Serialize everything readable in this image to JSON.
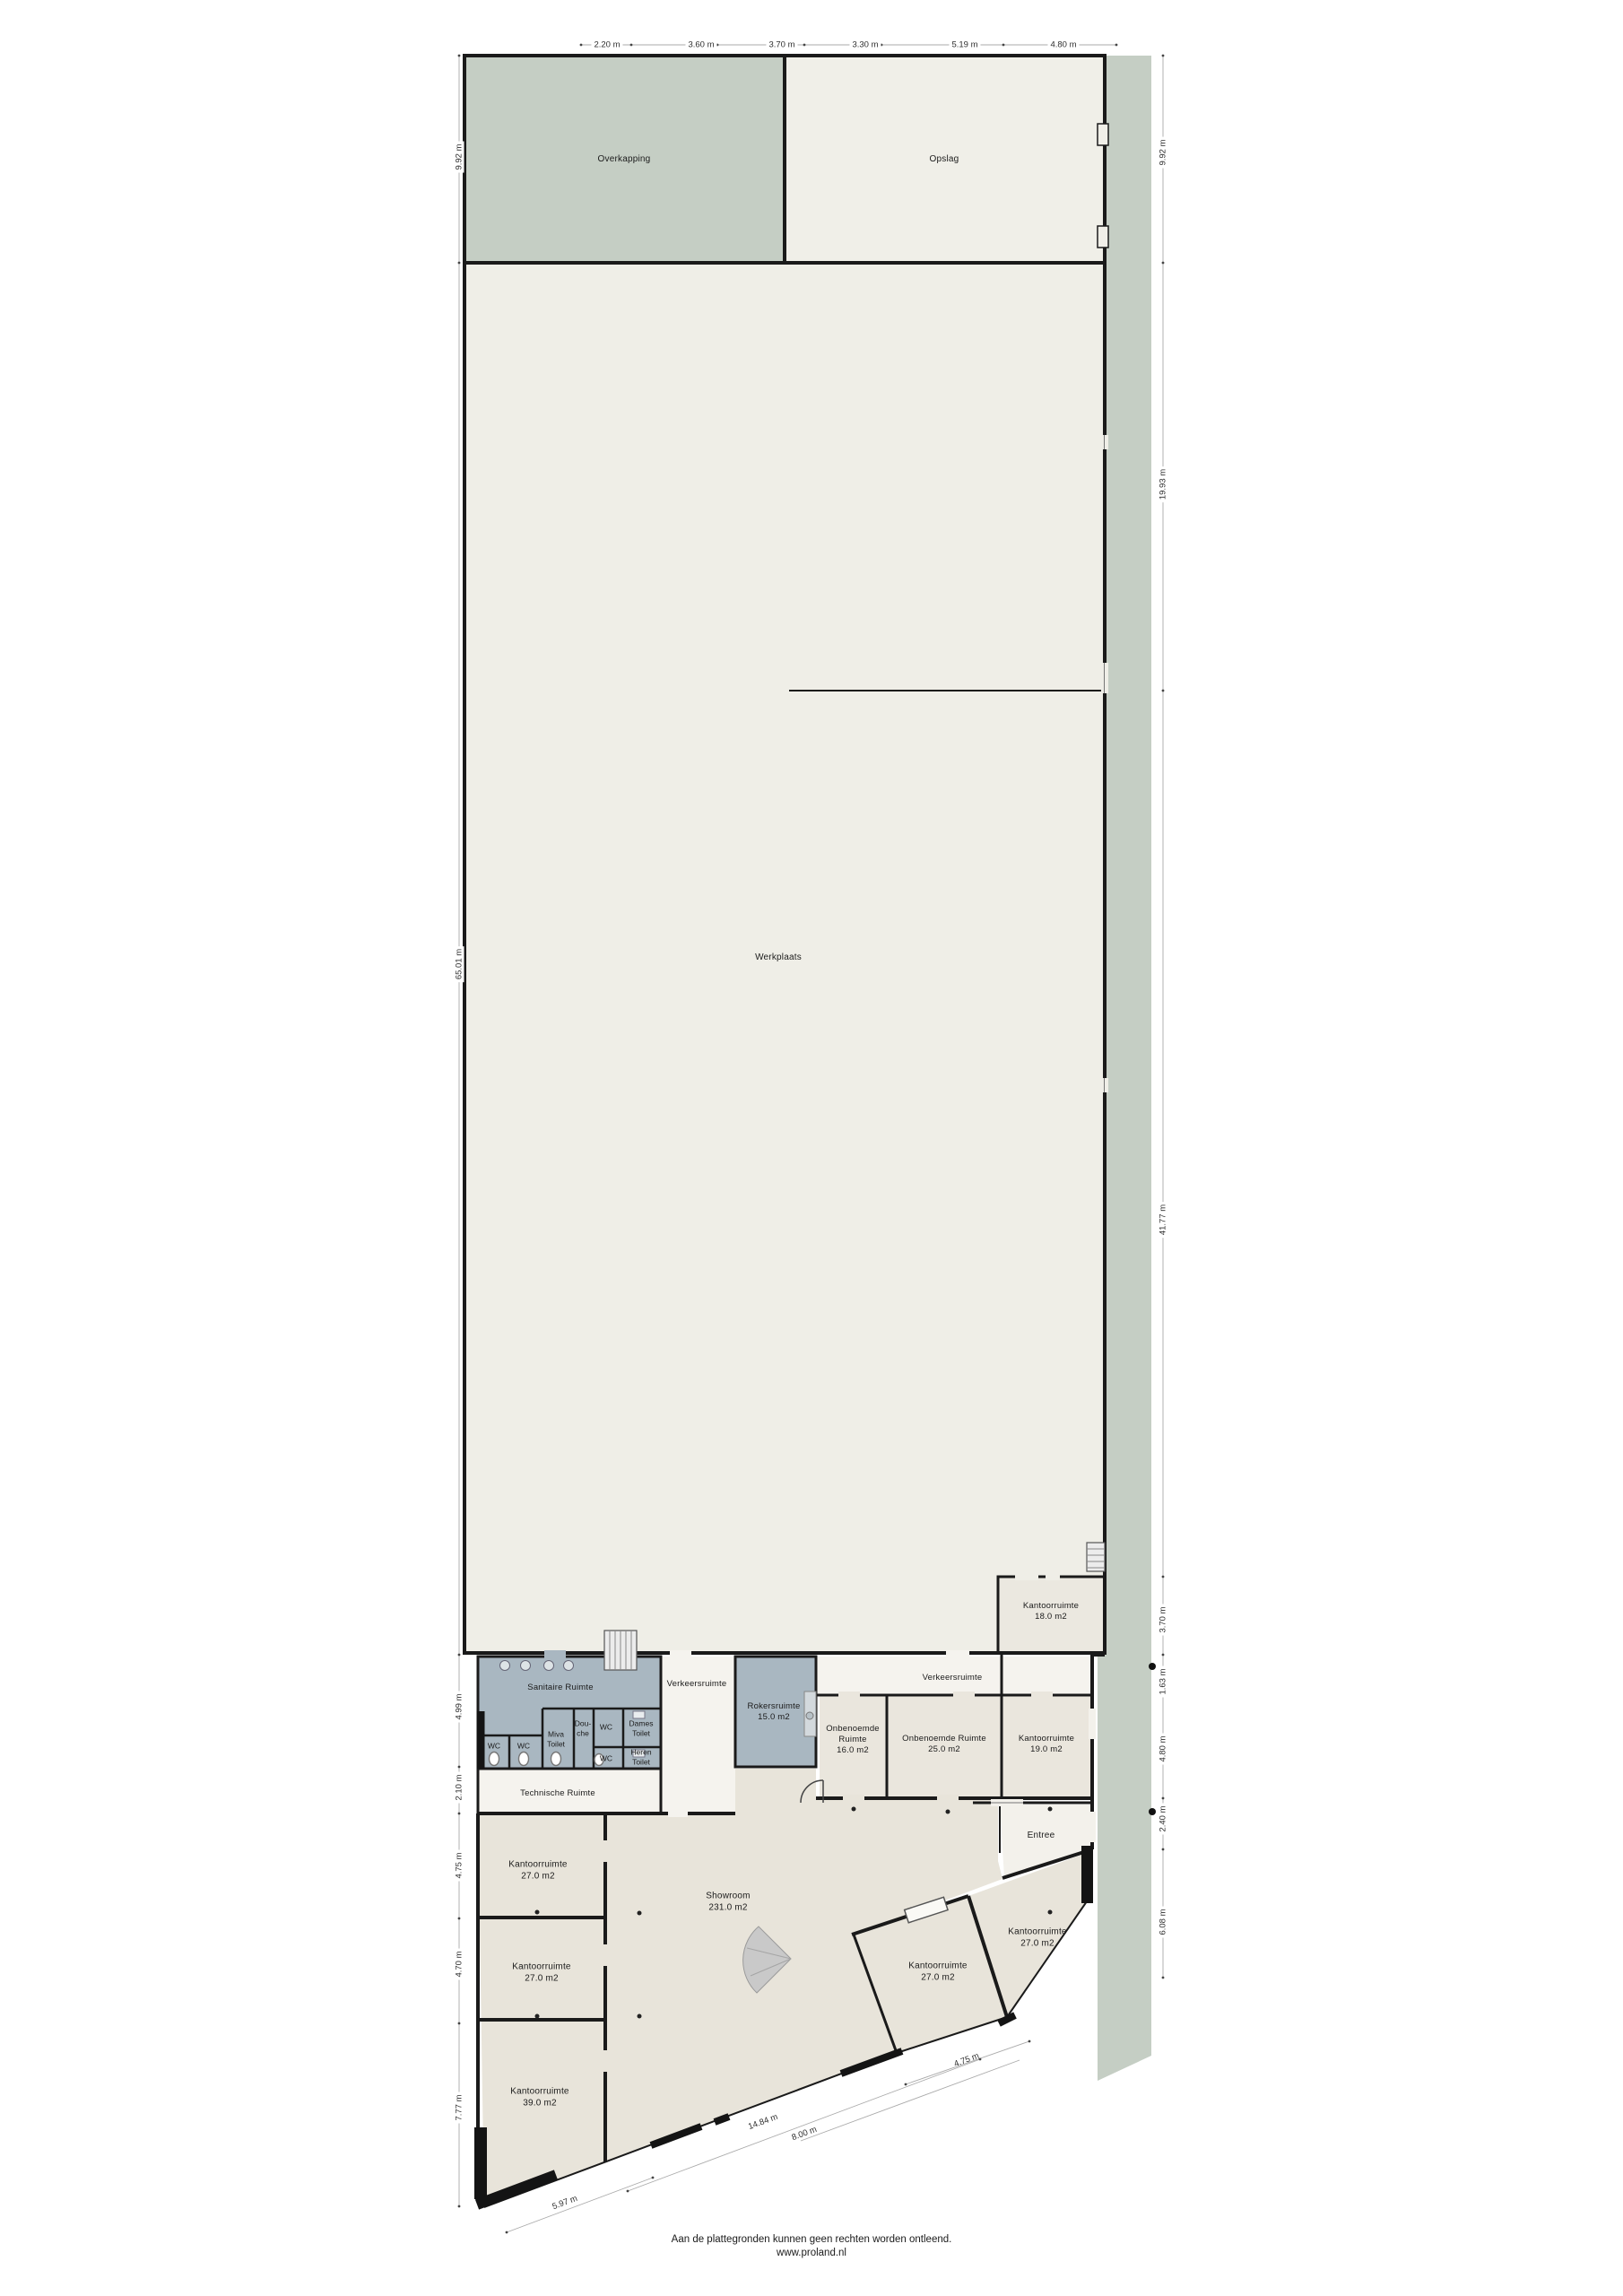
{
  "plan_type": "floorplan",
  "colors": {
    "site_green": "#c5cec4",
    "floor_light": "#efeee7",
    "floor_beige": "#e8e4da",
    "corridor_white": "#f5f3ee",
    "wet_room_blue": "#a9b7c1",
    "wall_black": "#1a1a1a"
  },
  "rooms": {
    "overkapping": "Overkapping",
    "opslag": "Opslag",
    "werkplaats": "Werkplaats",
    "kantoor18": "Kantoorruimte\n18.0 m2",
    "sanitaire": "Sanitaire Ruimte",
    "wc_a": "WC",
    "wc_b": "WC",
    "miva": "Miva\nToilet",
    "douche": "Dou-\nche",
    "wc_c": "WC",
    "dames": "Dames\nToilet",
    "wc_d": "WC",
    "heren": "Heren\nToilet",
    "verkeers_west": "Verkeersruimte",
    "rokers": "Rokersruimte\n15.0 m2",
    "verkeers_oost": "Verkeersruimte",
    "onbenoemd16": "Onbenoemde\nRuimte\n16.0 m2",
    "onbenoemd25": "Onbenoemde Ruimte\n25.0 m2",
    "kantoor19": "Kantoorruimte\n19.0 m2",
    "technisch": "Technische Ruimte",
    "entree": "Entree",
    "kantoor27_1": "Kantoorruimte\n27.0 m2",
    "kantoor27_2": "Kantoorruimte\n27.0 m2",
    "kantoor39": "Kantoorruimte\n39.0 m2",
    "showroom": "Showroom\n231.0 m2",
    "kantoor27_3": "Kantoorruimte\n27.0 m2",
    "kantoor27_4": "Kantoorruimte\n27.0 m2"
  },
  "dims": {
    "top": [
      "2.20 m",
      "3.60 m",
      "3.70 m",
      "3.30 m",
      "5.19 m",
      "4.80 m"
    ],
    "left": [
      "9.92 m",
      "65.01 m",
      "4.99 m",
      "2.10 m",
      "4.75 m",
      "4.70 m",
      "7.77 m"
    ],
    "right": [
      "9.92 m",
      "19.93 m",
      "41.77 m",
      "3.70 m",
      "1.63 m",
      "4.80 m",
      "2.40 m",
      "6.08 m"
    ],
    "bottom": [
      "5.97 m",
      "14.84 m",
      "8.00 m",
      "4.75 m"
    ]
  },
  "footer": {
    "disclaimer": "Aan de plattegronden kunnen geen rechten worden ontleend.",
    "website": "www.proland.nl"
  }
}
